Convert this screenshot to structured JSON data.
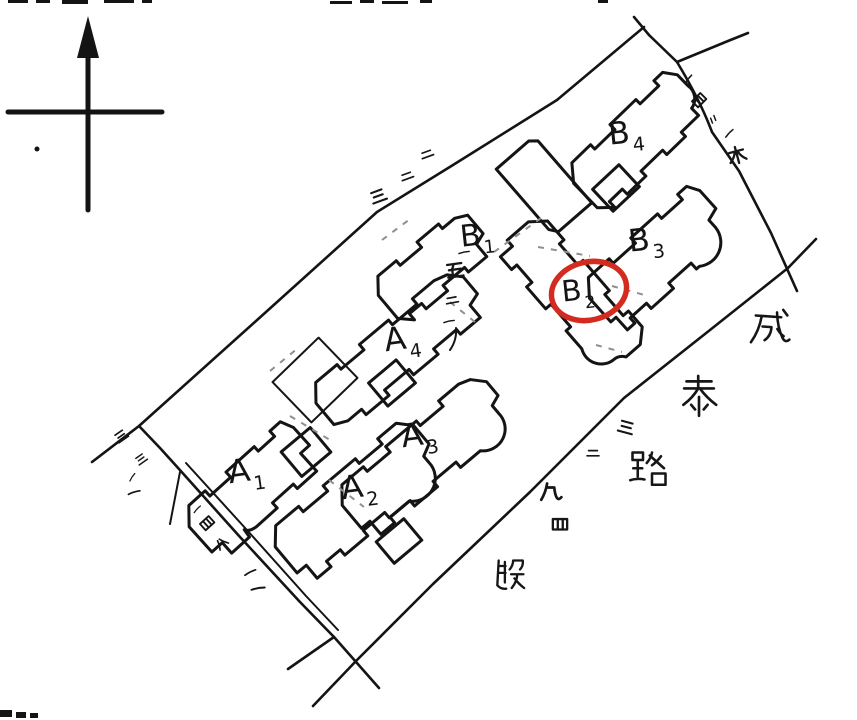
{
  "page": {
    "background": "#ffffff",
    "ink_color": "#141414",
    "highlight_color": "#d42b20",
    "type_note": "hand-drawn site location plan"
  },
  "compass": {
    "name": "north-arrow"
  },
  "buildings": [
    {
      "id": "A1",
      "letter": "A",
      "digit": "1",
      "circled": false
    },
    {
      "id": "A2",
      "letter": "A",
      "digit": "2",
      "circled": false
    },
    {
      "id": "A3",
      "letter": "A",
      "digit": "3",
      "circled": false
    },
    {
      "id": "A4",
      "letter": "A",
      "digit": "4",
      "circled": false
    },
    {
      "id": "B1",
      "letter": "B",
      "digit": "1",
      "circled": false
    },
    {
      "id": "B2",
      "letter": "B",
      "digit": "2",
      "circled": true
    },
    {
      "id": "B3",
      "letter": "B",
      "digit": "3",
      "circled": false
    },
    {
      "id": "B4",
      "letter": "B",
      "digit": "4",
      "circled": false
    }
  ],
  "road": {
    "name": "成泰路段",
    "name_chars": [
      "成",
      "泰",
      "路",
      "段"
    ]
  },
  "annotations": {
    "upper_boundary": "二二三",
    "b1_column": "一五二一",
    "road_column": "三二九四",
    "ne_edge": "一四〃一木",
    "left_edge": "三三一一",
    "sw_edge": "一四八一"
  }
}
